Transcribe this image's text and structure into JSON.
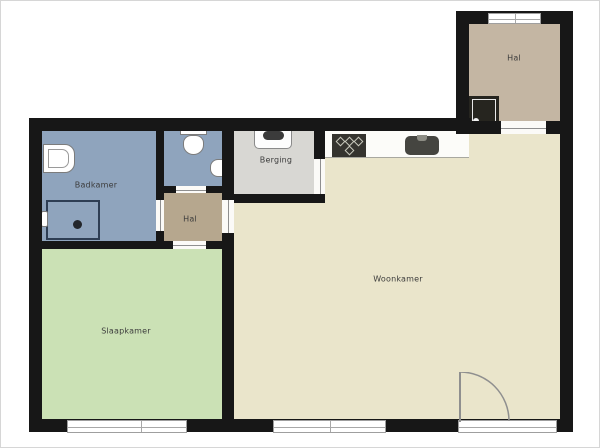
{
  "floorplan": {
    "type": "apartment-floor-plan",
    "rooms": {
      "badkamer": {
        "label": "Badkamer",
        "color": "#8fa4bd"
      },
      "wc": {
        "label": "",
        "color": "#8fa4bd"
      },
      "hal": {
        "label": "Hal",
        "color": "#b6a78e"
      },
      "berging": {
        "label": "Berging",
        "color": "#d8d7d3"
      },
      "woonkamer": {
        "label": "Woonkamer",
        "color": "#eae5cb"
      },
      "slaapkamer": {
        "label": "Slaapkamer",
        "color": "#cbe1b5"
      },
      "entrance_hal": {
        "label": "Hal",
        "color": "#c4b6a3"
      }
    },
    "fixtures": [
      "washbasin",
      "shower",
      "shower-drain",
      "shower-tap",
      "toilet",
      "hand-basin",
      "boiler-unit",
      "stove",
      "kitchen-sink",
      "kitchen-counter",
      "service-shaft",
      "terrace-door",
      "entrance-window",
      "bedroom-window",
      "livingroom-window"
    ],
    "colors": {
      "wall": "#171717",
      "background": "#ffffff",
      "window_frame": "#9f9f9f",
      "label_text": "#3c3c3c"
    }
  }
}
